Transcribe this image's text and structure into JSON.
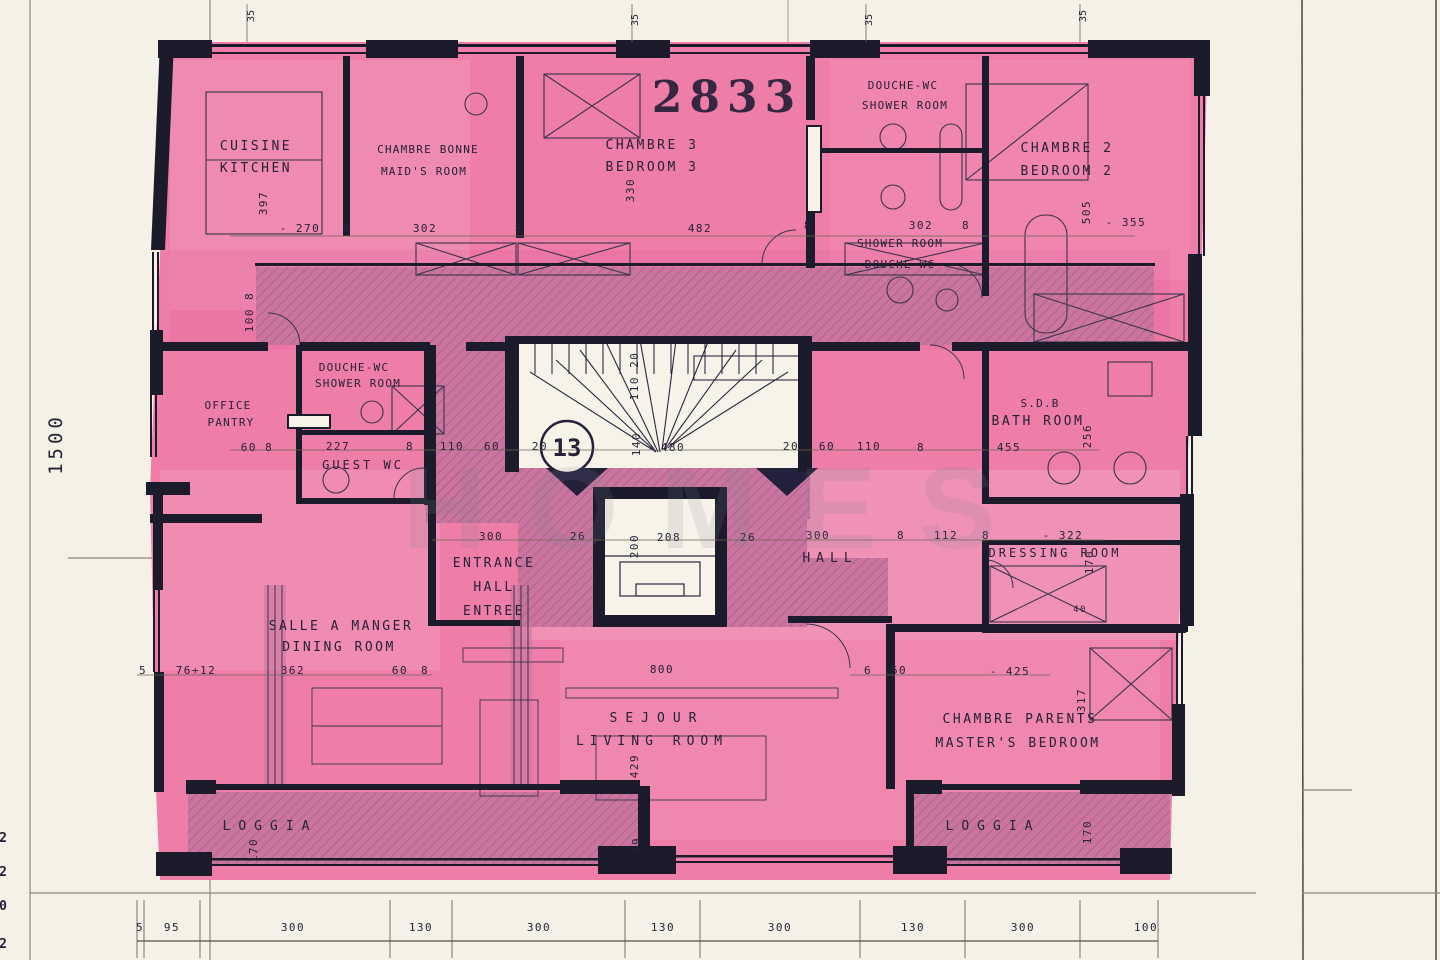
{
  "plan": {
    "number": "2833",
    "level_badge": "13",
    "scale_left": "1500"
  },
  "watermark": "HOMES",
  "rooms": {
    "kitchen": {
      "fr": "CUISINE",
      "en": "KITCHEN"
    },
    "maids_room": {
      "fr": "CHAMBRE BONNE",
      "en": "MAID'S ROOM"
    },
    "bedroom3": {
      "fr": "CHAMBRE 3",
      "en": "BEDROOM 3"
    },
    "shower_top": {
      "fr": "DOUCHE-WC",
      "en": "SHOWER ROOM"
    },
    "shower_mid": {
      "en": "SHOWER ROOM",
      "fr": "DOUCHE-WC"
    },
    "bedroom2": {
      "fr": "CHAMBRE 2",
      "en": "BEDROOM 2"
    },
    "office": {
      "l1": "OFFICE",
      "l2": "PANTRY"
    },
    "shower_small": {
      "fr": "DOUCHE-WC",
      "en": "SHOWER ROOM"
    },
    "guest_wc": "GUEST WC",
    "bathroom": {
      "fr": "S.D.B",
      "en": "BATH ROOM"
    },
    "entrance": {
      "l1": "ENTRANCE",
      "l2": "HALL",
      "l3": "ENTREE"
    },
    "hall": "HALL",
    "dressing": "DRESSING ROOM",
    "dining": {
      "fr": "SALLE A MANGER",
      "en": "DINING ROOM"
    },
    "living": {
      "fr": "SEJOUR",
      "en": "LIVING ROOM"
    },
    "master": {
      "fr": "CHAMBRE PARENTS",
      "en": "MASTER'S BEDROOM"
    },
    "loggia_left": "LOGGIA",
    "loggia_right": "LOGGIA"
  },
  "dims": {
    "top": [
      "- 270",
      "8",
      "302",
      "8",
      "482",
      "8",
      "302",
      "8",
      "- 355"
    ],
    "top_vertical": {
      "kitchen": "397",
      "bedroom3": "330",
      "bedroom2": "505",
      "corridor_left": "100 8"
    },
    "mid": [
      "60 8",
      "227",
      "8",
      "110",
      "60",
      "20",
      "480",
      "20",
      "60",
      "110",
      "8",
      "455"
    ],
    "mid_vertical": {
      "stair_upper": "110 20",
      "stair": "140",
      "bathroom": "256"
    },
    "hall": [
      "300",
      "26",
      "208",
      "26",
      "300",
      "8",
      "112",
      "8",
      "- 322"
    ],
    "hall_vertical": {
      "lift": "200",
      "dressing": "170"
    },
    "dressing_width": "40",
    "dining": [
      "5",
      "76+12",
      "362",
      "60",
      "8"
    ],
    "living": [
      "800",
      "6",
      "60",
      "- 425"
    ],
    "living_vertical": {
      "living": "429",
      "master": "317",
      "loggia_left": "170",
      "loggia_right": "170",
      "bottom": "19"
    },
    "bottom": [
      "5",
      "95",
      "300",
      "130",
      "300",
      "130",
      "300",
      "130",
      "300",
      "100"
    ],
    "top_ticks": [
      "35",
      "35",
      "35",
      "35"
    ]
  },
  "margin_marks": [
    "2",
    "2",
    "0",
    "2"
  ],
  "colors": {
    "paper": "#f5f1e6",
    "pink": "#ee7da8",
    "hatch_base": "#c9759f",
    "hatch_line": "#9c4e78",
    "wall": "#1c1b2b",
    "ink": "#272136"
  }
}
